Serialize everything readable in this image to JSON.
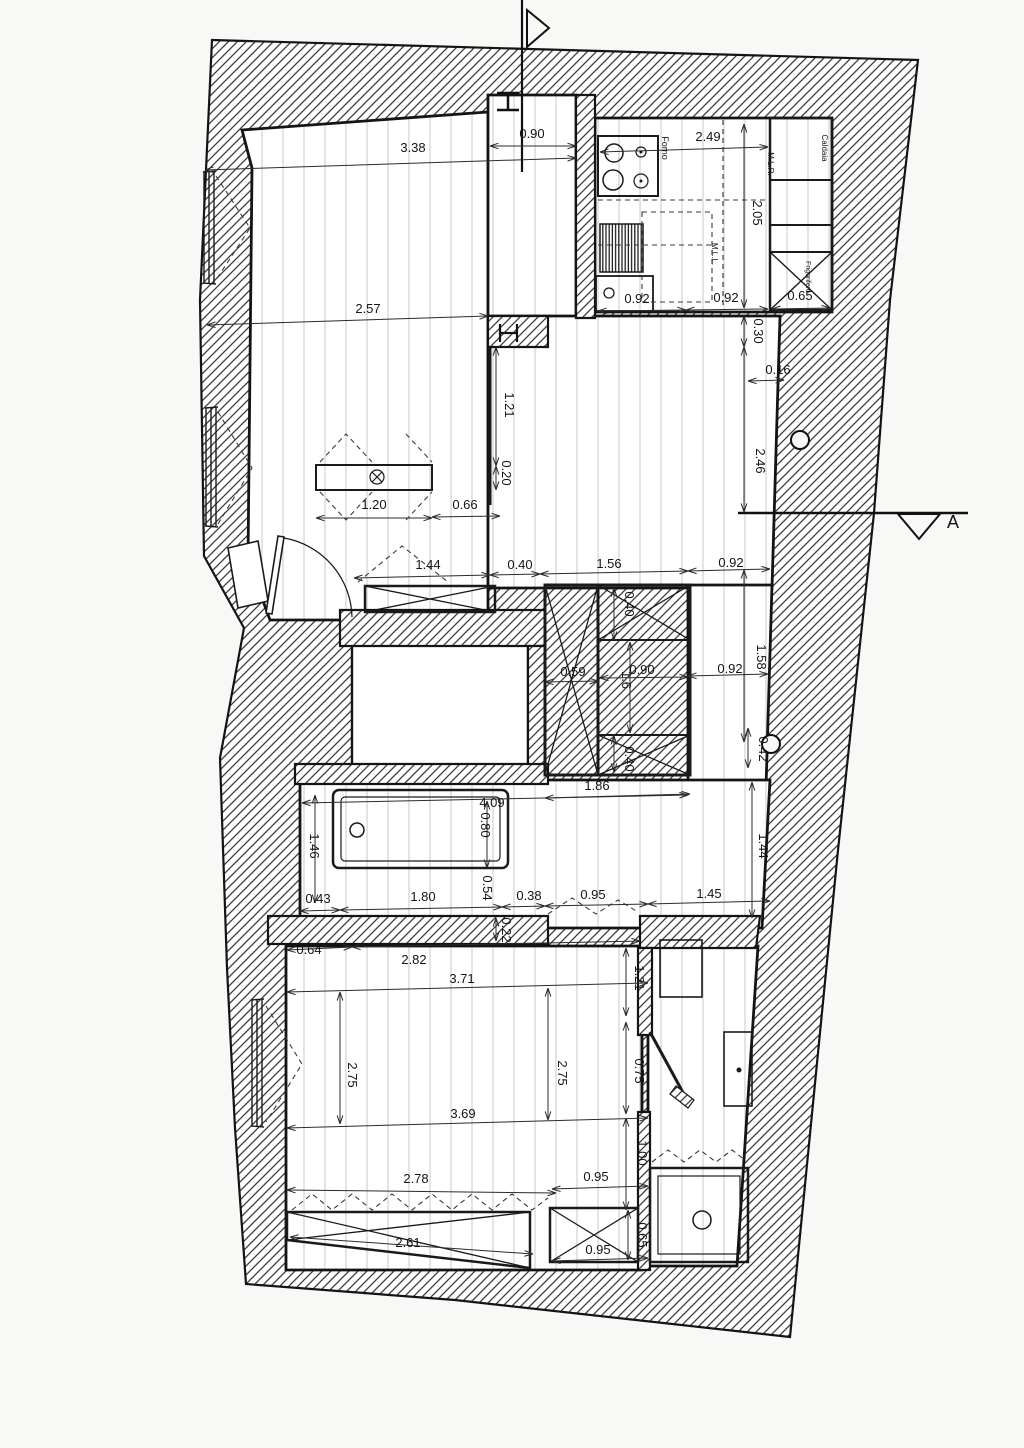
{
  "drawing": {
    "type": "apartment-floor-plan",
    "section_marker": "A",
    "colors": {
      "paper": "#f8f8f6",
      "line": "#141414",
      "hatch": "#3a3a3a",
      "floor_stripe": "#c9c9c9"
    },
    "fixtures": [
      "stove",
      "oven",
      "boiler",
      "fridge",
      "kitchen-sink",
      "radiator",
      "table",
      "bathtub",
      "shower-tray",
      "washbasin",
      "cabinet",
      "wardrobe",
      "closet",
      "entry-door",
      "window",
      "section-line"
    ],
    "labels": [
      {
        "t": "0.90",
        "x": 532,
        "y": 138,
        "r": 0
      },
      {
        "t": "3.38",
        "x": 413,
        "y": 152,
        "r": 0
      },
      {
        "t": "2.49",
        "x": 708,
        "y": 141,
        "r": 0
      },
      {
        "t": "Forno",
        "x": 662,
        "y": 148,
        "r": 90,
        "s": 9,
        "n": "label-oven"
      },
      {
        "t": "M.L.R.",
        "x": 768,
        "y": 164,
        "r": 90,
        "s": 8,
        "n": "label-mlr"
      },
      {
        "t": "Caldaia",
        "x": 822,
        "y": 148,
        "r": 90,
        "s": 8,
        "n": "label-boiler"
      },
      {
        "t": "2.05",
        "x": 753,
        "y": 213,
        "r": 90
      },
      {
        "t": "M.L.L.",
        "x": 712,
        "y": 254,
        "r": 90,
        "s": 8,
        "n": "label-mll"
      },
      {
        "t": "Frigorifero",
        "x": 806,
        "y": 277,
        "r": 90,
        "s": 7,
        "n": "label-fridge"
      },
      {
        "t": "0.92",
        "x": 637,
        "y": 303,
        "r": 0
      },
      {
        "t": "0.92",
        "x": 726,
        "y": 302,
        "r": 0
      },
      {
        "t": "0.65",
        "x": 800,
        "y": 300,
        "r": 0
      },
      {
        "t": "2.57",
        "x": 368,
        "y": 313,
        "r": 0
      },
      {
        "t": "0.30",
        "x": 754,
        "y": 331,
        "r": 90
      },
      {
        "t": "0.16",
        "x": 778,
        "y": 374,
        "r": 0
      },
      {
        "t": "1.21",
        "x": 505,
        "y": 405,
        "r": 90
      },
      {
        "t": "2.46",
        "x": 756,
        "y": 461,
        "r": 90
      },
      {
        "t": "0.20",
        "x": 502,
        "y": 473,
        "r": 90
      },
      {
        "t": "1.20",
        "x": 374,
        "y": 509,
        "r": 0
      },
      {
        "t": "0.66",
        "x": 465,
        "y": 509,
        "r": 0
      },
      {
        "t": "A",
        "x": 953,
        "y": 528,
        "r": 0,
        "s": 18,
        "n": "section-label-a"
      },
      {
        "t": "1.44",
        "x": 428,
        "y": 569,
        "r": 0
      },
      {
        "t": "0.40",
        "x": 520,
        "y": 569,
        "r": 0
      },
      {
        "t": "1.56",
        "x": 609,
        "y": 568,
        "r": 0
      },
      {
        "t": "0.92",
        "x": 731,
        "y": 567,
        "r": 0
      },
      {
        "t": "0.40",
        "x": 625,
        "y": 604,
        "r": 90
      },
      {
        "t": "1.58",
        "x": 757,
        "y": 657,
        "r": 90
      },
      {
        "t": "0.59",
        "x": 573,
        "y": 676,
        "r": 0
      },
      {
        "t": "0.90",
        "x": 642,
        "y": 674,
        "r": 0
      },
      {
        "t": "1.6",
        "x": 622,
        "y": 680,
        "r": 90
      },
      {
        "t": "0.92",
        "x": 730,
        "y": 673,
        "r": 0
      },
      {
        "t": "0.40",
        "x": 625,
        "y": 759,
        "r": 90
      },
      {
        "t": "0.42",
        "x": 759,
        "y": 749,
        "r": 90
      },
      {
        "t": "1.86",
        "x": 597,
        "y": 790,
        "r": 0
      },
      {
        "t": "4.09",
        "x": 492,
        "y": 807,
        "r": 0
      },
      {
        "t": "0.80",
        "x": 481,
        "y": 825,
        "r": 90
      },
      {
        "t": "1.46",
        "x": 310,
        "y": 846,
        "r": 90
      },
      {
        "t": "1.44",
        "x": 759,
        "y": 846,
        "r": 90
      },
      {
        "t": "0.43",
        "x": 318,
        "y": 903,
        "r": 0
      },
      {
        "t": "1.80",
        "x": 423,
        "y": 901,
        "r": 0
      },
      {
        "t": "0.54",
        "x": 483,
        "y": 888,
        "r": 90
      },
      {
        "t": "0.38",
        "x": 529,
        "y": 900,
        "r": 0
      },
      {
        "t": "0.95",
        "x": 593,
        "y": 899,
        "r": 0
      },
      {
        "t": "1.45",
        "x": 709,
        "y": 898,
        "r": 0
      },
      {
        "t": "0.22",
        "x": 502,
        "y": 930,
        "r": 90
      },
      {
        "t": "0.64",
        "x": 309,
        "y": 954,
        "r": 0
      },
      {
        "t": "2.82",
        "x": 414,
        "y": 964,
        "r": 0
      },
      {
        "t": "3.71",
        "x": 462,
        "y": 983,
        "r": 0
      },
      {
        "t": "1.21",
        "x": 635,
        "y": 978,
        "r": 90
      },
      {
        "t": "2.75",
        "x": 348,
        "y": 1075,
        "r": 90
      },
      {
        "t": "2.75",
        "x": 558,
        "y": 1073,
        "r": 90
      },
      {
        "t": "0.75",
        "x": 635,
        "y": 1071,
        "r": 90
      },
      {
        "t": "3.69",
        "x": 463,
        "y": 1118,
        "r": 0
      },
      {
        "t": "1.00",
        "x": 638,
        "y": 1153,
        "r": 90
      },
      {
        "t": "0.95",
        "x": 596,
        "y": 1181,
        "r": 0
      },
      {
        "t": "2.78",
        "x": 416,
        "y": 1183,
        "r": 0
      },
      {
        "t": "2.61",
        "x": 408,
        "y": 1247,
        "r": 0
      },
      {
        "t": "0.95",
        "x": 598,
        "y": 1254,
        "r": 0
      },
      {
        "t": "0.65",
        "x": 638,
        "y": 1235,
        "r": 90
      }
    ],
    "dim_lines": [
      [
        490,
        146,
        576,
        146
      ],
      [
        205,
        170,
        576,
        158
      ],
      [
        600,
        152,
        768,
        147
      ],
      [
        744,
        124,
        744,
        308
      ],
      [
        598,
        311,
        686,
        310
      ],
      [
        686,
        310,
        768,
        309
      ],
      [
        772,
        309,
        830,
        308
      ],
      [
        207,
        325,
        488,
        316
      ],
      [
        744,
        316,
        744,
        347
      ],
      [
        748,
        381,
        784,
        380
      ],
      [
        496,
        347,
        496,
        466
      ],
      [
        496,
        466,
        496,
        490
      ],
      [
        744,
        347,
        744,
        512
      ],
      [
        316,
        518,
        432,
        518
      ],
      [
        432,
        517,
        500,
        516
      ],
      [
        354,
        578,
        490,
        575
      ],
      [
        490,
        575,
        540,
        574
      ],
      [
        540,
        574,
        688,
        571
      ],
      [
        688,
        571,
        770,
        569
      ],
      [
        614,
        588,
        614,
        640
      ],
      [
        545,
        682,
        598,
        681
      ],
      [
        600,
        678,
        688,
        677
      ],
      [
        630,
        642,
        630,
        733
      ],
      [
        688,
        676,
        768,
        674
      ],
      [
        744,
        570,
        744,
        742
      ],
      [
        614,
        736,
        614,
        772
      ],
      [
        748,
        728,
        748,
        768
      ],
      [
        545,
        798,
        690,
        794
      ],
      [
        302,
        803,
        688,
        795
      ],
      [
        487,
        801,
        487,
        868
      ],
      [
        315,
        795,
        315,
        903
      ],
      [
        752,
        782,
        752,
        918
      ],
      [
        300,
        911,
        340,
        910
      ],
      [
        340,
        910,
        502,
        907
      ],
      [
        502,
        907,
        545,
        906
      ],
      [
        545,
        906,
        648,
        904
      ],
      [
        648,
        904,
        770,
        901
      ],
      [
        496,
        918,
        496,
        941
      ],
      [
        287,
        950,
        352,
        947
      ],
      [
        352,
        947,
        640,
        941
      ],
      [
        287,
        992,
        648,
        983
      ],
      [
        626,
        948,
        626,
        1016
      ],
      [
        340,
        992,
        340,
        1124
      ],
      [
        548,
        988,
        548,
        1120
      ],
      [
        626,
        1022,
        626,
        1114
      ],
      [
        287,
        1128,
        648,
        1118
      ],
      [
        626,
        1118,
        626,
        1210
      ],
      [
        552,
        1189,
        648,
        1186
      ],
      [
        287,
        1190,
        556,
        1193
      ],
      [
        290,
        1237,
        533,
        1254
      ],
      [
        552,
        1261,
        648,
        1258
      ],
      [
        628,
        1210,
        628,
        1260
      ]
    ]
  }
}
